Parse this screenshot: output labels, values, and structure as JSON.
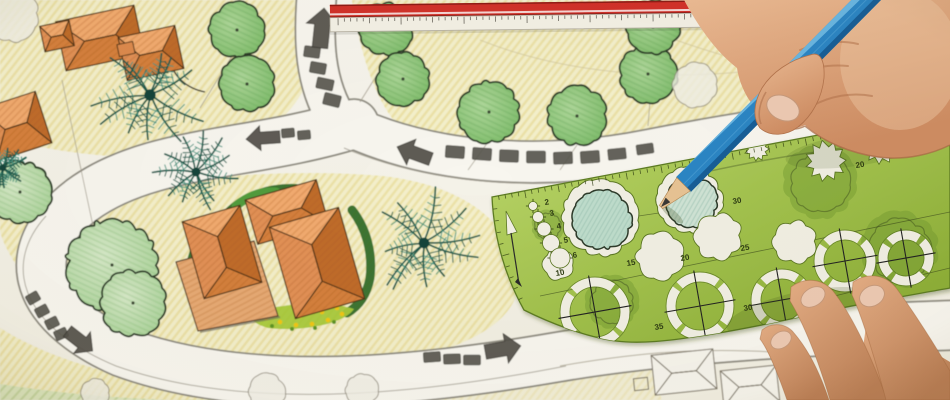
{
  "colors": {
    "paper": "#f6f4ec",
    "paper2": "#f1eee2",
    "lawnFill": "#f3eec6",
    "lawnLine": "#e6da92",
    "lawnGreen": "#dfe8c0",
    "lawnGreenLine": "#c3d59c",
    "roadFill": "#f8f6ef",
    "roadEdge": "#8e8b80",
    "roadThin": "#a09c90",
    "paver": "#5a5850",
    "arrow": "#53514a",
    "ink": "#3a382f",
    "leader": "#a39d8d",
    "arc": "#d2c79c",
    "treeStroke": "#2c3a28",
    "treeMidA": "#aed79a",
    "treeMidB": "#7cbb68",
    "treePaleA": "#d6e9c8",
    "treePaleB": "#a9d398",
    "treeOutline": "#8f897a",
    "palmDark": "#1d5a4c",
    "palmLight": "#459480",
    "roofTop": "#f2ab70",
    "roofBottom": "#d5803d",
    "roofLeft": "#e29157",
    "roofRight": "#c06c2c",
    "roofStroke": "#4a3118",
    "patio": "#e7aa74",
    "hedgeDark": "#2f6a26",
    "hedgeBright": "#54a03e",
    "bedGreen": "#a9c93c",
    "flowerYellow": "#f0c614",
    "flowerGreen": "#5f9427",
    "rulerRed": "#d2322a",
    "rulerRedDark": "#8e1d18",
    "rulerWhite": "#f4f1e6",
    "tick": "#55524a",
    "tplLight": "#bcd76b",
    "tplDark": "#86a830",
    "tplInk": "#2f3d12",
    "tplEdge": "#5d7c24",
    "holePaper": "#f1efe3",
    "holeEdge": "#5b7724",
    "drawnInk": "#2f3b2c",
    "pencilBody": "#2b85c4",
    "pencilLite": "#6db8e4",
    "pencilDark": "#175e97",
    "pencilRidge": "#4da0d4",
    "wood": "#e7c394",
    "woodEdge": "#b5854f",
    "graphite": "#3a3936",
    "skinCrease": "#b3734c",
    "nail": "#edcab3",
    "nailEdge": "#c79a7c",
    "sketch": "#7b7466"
  },
  "plan": {
    "lawns": [
      {
        "d": "M340,0 L950,0 L950,108 C850,124 760,140 655,154 C560,166 468,163 412,138 C382,118 362,66 352,0 Z",
        "o": 1
      },
      {
        "d": "M0,0 L332,0 C324,58 304,108 258,138 C180,168 78,158 0,138 Z",
        "o": 1
      },
      {
        "d": "M0,218 C120,182 262,166 382,176 C472,186 520,230 518,288 C510,338 418,368 298,374 C178,378 80,350 40,300 C14,264 0,240 0,228 Z",
        "o": 1
      },
      {
        "d": "M0,400 L0,328 C60,366 152,388 262,395 C330,399 390,397 436,391 L436,400 Z",
        "o": 1
      },
      {
        "d": "M436,400 L436,391 C520,380 592,370 650,366 L662,400 Z",
        "o": 0.5
      }
    ],
    "lawn_green": "M0,400 L0,384 C80,397 170,402 250,401 L250,400 Z",
    "roads": [
      {
        "d": "M318,-20 C312,40 314,85 340,124",
        "w": 38
      },
      {
        "d": "M330,116 C420,165 540,172 650,150 C760,128 850,118 960,104",
        "w": 40
      },
      {
        "d": "M354,124 C250,156 150,150 82,200 C18,248 28,310 122,352 C252,400 424,380 558,357 C652,341 780,331 960,325",
        "w": 48
      }
    ],
    "road_lines": [
      "M344,148 C440,188 556,192 660,170 C766,148 862,138 950,126",
      "M46,216 C4,262 16,324 116,366 C252,414 432,392 566,366"
    ],
    "arcs": [
      "M480,40 C560,72 660,82 760,70",
      "M640,26 C740,68 850,88 950,80"
    ],
    "leaders": [
      [
        232,
        56,
        200,
        108
      ],
      [
        390,
        54,
        360,
        102
      ],
      [
        488,
        142,
        468,
        170
      ],
      [
        62,
        80,
        96,
        240
      ],
      [
        650,
        101,
        648,
        126
      ],
      [
        118,
        224,
        112,
        262
      ],
      [
        24,
        164,
        20,
        190
      ],
      [
        577,
        145,
        560,
        170
      ]
    ],
    "trees_mid": [
      [
        237,
        30,
        27
      ],
      [
        247,
        84,
        27
      ],
      [
        386,
        29,
        26
      ],
      [
        403,
        79,
        26
      ],
      [
        489,
        112,
        30
      ],
      [
        577,
        116,
        29
      ],
      [
        648,
        74,
        28
      ],
      [
        653,
        27,
        26
      ]
    ],
    "trees_pale": [
      [
        20,
        192,
        30
      ],
      [
        112,
        265,
        44
      ],
      [
        133,
        303,
        32
      ],
      [
        860,
        32,
        26
      ]
    ],
    "trees_outline": [
      [
        12,
        15,
        26
      ],
      [
        695,
        85,
        22
      ],
      [
        267,
        392,
        18
      ],
      [
        362,
        390,
        16
      ],
      [
        95,
        393,
        14
      ]
    ],
    "palms": [
      [
        150,
        95,
        60
      ],
      [
        196,
        172,
        42
      ],
      [
        424,
        243,
        55
      ],
      [
        3,
        168,
        24
      ]
    ],
    "buildings": [
      {
        "x": 287,
        "y": 212,
        "w": 74,
        "h": 46,
        "rot": -16
      },
      {
        "x": 222,
        "y": 252,
        "w": 60,
        "h": 80,
        "rot": -16
      },
      {
        "x": 317,
        "y": 263,
        "w": 72,
        "h": 95,
        "rot": -16
      },
      {
        "x": 100,
        "y": 38,
        "w": 80,
        "h": 50,
        "rot": -12
      },
      {
        "x": 57,
        "y": 36,
        "w": 30,
        "h": 26,
        "rot": -12
      },
      {
        "x": 151,
        "y": 53,
        "w": 58,
        "h": 44,
        "rot": -12
      },
      {
        "x": 16,
        "y": 126,
        "w": 58,
        "h": 54,
        "rot": -18
      }
    ],
    "connector": {
      "x": 126,
      "y": 49,
      "w": 16,
      "h": 12,
      "rot": -12
    },
    "patio": "M176,262 L254,241 L278,316 L198,331 Z",
    "hedges": [
      {
        "d": "M228,212 C244,196 268,187 296,188",
        "w": 8,
        "c": "dark"
      },
      {
        "d": "M196,246 C188,264 186,286 193,304",
        "w": 8,
        "c": "dark"
      },
      {
        "d": "M352,210 C366,228 373,252 370,278 C367,294 359,306 347,313",
        "w": 9,
        "c": "dark"
      },
      {
        "d": "M236,206 C248,196 262,191 276,192",
        "w": 9,
        "c": "bright"
      }
    ],
    "flowerbed": {
      "d": "M252,312 C284,303 330,301 354,309 C344,324 302,332 268,328 C254,324 248,318 252,312 Z",
      "yellow": [
        [
          266,
          318
        ],
        [
          280,
          322
        ],
        [
          296,
          325
        ],
        [
          312,
          324
        ],
        [
          328,
          320
        ],
        [
          342,
          314
        ],
        [
          275,
          313
        ],
        [
          300,
          316
        ],
        [
          322,
          312
        ],
        [
          337,
          308
        ]
      ],
      "green": [
        [
          272,
          326
        ],
        [
          292,
          329
        ],
        [
          315,
          328
        ],
        [
          334,
          322
        ]
      ]
    },
    "pavers": [
      [
        312,
        52,
        16,
        11,
        8
      ],
      [
        318,
        68,
        16,
        11,
        10
      ],
      [
        325,
        84,
        17,
        11,
        12
      ],
      [
        332,
        100,
        17,
        12,
        14
      ],
      [
        288,
        133,
        13,
        9,
        -5
      ],
      [
        304,
        135,
        13,
        9,
        -5
      ],
      [
        455,
        152,
        19,
        12,
        4
      ],
      [
        482,
        154,
        19,
        12,
        4
      ],
      [
        509,
        156,
        19,
        12,
        2
      ],
      [
        536,
        157,
        19,
        12,
        0
      ],
      [
        563,
        158,
        19,
        12,
        -2
      ],
      [
        590,
        157,
        19,
        12,
        -4
      ],
      [
        617,
        154,
        18,
        11,
        -6
      ],
      [
        645,
        149,
        17,
        10,
        -8
      ],
      [
        33,
        298,
        13,
        10,
        -30
      ],
      [
        42,
        311,
        13,
        10,
        -28
      ],
      [
        52,
        323,
        13,
        10,
        -26
      ],
      [
        61,
        334,
        13,
        10,
        -24
      ],
      [
        432,
        357,
        17,
        10,
        -4
      ],
      [
        452,
        359,
        17,
        10,
        -2
      ],
      [
        472,
        360,
        17,
        10,
        0
      ]
    ],
    "arrows": [
      {
        "x": 322,
        "y": 28,
        "len": 40,
        "wid": 26,
        "rot": -84
      },
      {
        "x": 263,
        "y": 138,
        "len": 34,
        "wid": 20,
        "rot": 176
      },
      {
        "x": 414,
        "y": 153,
        "len": 36,
        "wid": 22,
        "rot": 200
      },
      {
        "x": 80,
        "y": 341,
        "len": 32,
        "wid": 22,
        "rot": 38
      },
      {
        "x": 503,
        "y": 349,
        "len": 36,
        "wid": 24,
        "rot": -10
      }
    ],
    "curve_arrow": {
      "d": "M205,92 C185,88 172,75 170,58",
      "head": [
        [
          166,
          60
        ],
        [
          171,
          48
        ],
        [
          176,
          60
        ]
      ]
    },
    "sketch_roofs": [
      {
        "x": 684,
        "y": 372,
        "w": 62,
        "h": 40,
        "rot": -6
      },
      {
        "x": 750,
        "y": 386,
        "w": 56,
        "h": 36,
        "rot": -6
      }
    ],
    "sketch_rect": [
      641,
      384,
      14,
      12,
      -6
    ],
    "sketch_arc": "M560,366 C640,352 700,348 772,352"
  },
  "ruler": {
    "x": 330,
    "y": 1,
    "w": 628,
    "red_h": 13,
    "body_h": 14,
    "rot": -0.7,
    "tick_step": 6.3
  },
  "template": {
    "outline": "M492,197 Q700,158 950,110 L950,288 C900,297 858,304 818,313 C778,322 740,330 700,336 C668,341 640,344 616,341 C585,337 548,322 524,310 Q495,258 492,197 Z",
    "top_edge": {
      "p0": [
        492,
        197
      ],
      "c": [
        700,
        160
      ],
      "p1": [
        950,
        110
      ]
    },
    "left_edge": {
      "p0": [
        492,
        197
      ],
      "c": [
        497,
        258
      ],
      "p1": [
        524,
        310
      ]
    },
    "holes_scallop": [
      {
        "x": 600,
        "y": 218,
        "r": 37,
        "inner": "#bedccb"
      },
      {
        "x": 690,
        "y": 200,
        "r": 32,
        "inner": "#cfe3d4"
      }
    ],
    "holes_spiky": [
      [
        826,
        161,
        20
      ],
      [
        881,
        145,
        19
      ],
      [
        919,
        139,
        12
      ],
      [
        757,
        149,
        12
      ]
    ],
    "holes_cloud": [
      [
        660,
        256,
        22
      ],
      [
        718,
        237,
        22
      ],
      [
        795,
        242,
        20
      ]
    ],
    "holes_flower": [
      [
        558,
        264,
        14
      ]
    ],
    "holes_circle": [
      [
        533,
        206,
        4.5
      ],
      [
        538,
        217,
        5.5
      ],
      [
        544,
        229,
        7
      ],
      [
        551,
        243,
        8.5
      ],
      [
        560,
        258,
        10
      ]
    ],
    "pennant": {
      "tri": [
        [
          506,
          211
        ],
        [
          517,
          232
        ],
        [
          507,
          235
        ]
      ],
      "stem": [
        [
          511,
          233
        ],
        [
          519,
          284
        ]
      ]
    },
    "rings": [
      [
        595,
        312,
        30
      ],
      [
        700,
        306,
        29
      ],
      [
        782,
        300,
        26
      ],
      [
        845,
        261,
        26
      ],
      [
        906,
        258,
        23
      ]
    ],
    "labels": [
      {
        "t": "2",
        "x": 545,
        "y": 205
      },
      {
        "t": "3",
        "x": 550,
        "y": 216
      },
      {
        "t": "4",
        "x": 557,
        "y": 229
      },
      {
        "t": "5",
        "x": 564,
        "y": 243
      },
      {
        "t": "6",
        "x": 573,
        "y": 258
      },
      {
        "t": "10",
        "x": 556,
        "y": 276
      },
      {
        "t": "15",
        "x": 627,
        "y": 266
      },
      {
        "t": "20",
        "x": 681,
        "y": 261
      },
      {
        "t": "25",
        "x": 741,
        "y": 251
      },
      {
        "t": "30",
        "x": 733,
        "y": 204
      },
      {
        "t": "35",
        "x": 655,
        "y": 330
      },
      {
        "t": "30",
        "x": 744,
        "y": 311
      },
      {
        "t": "20",
        "x": 856,
        "y": 168
      }
    ],
    "guides": [
      "M540,296 L950,212",
      "M585,224 L706,206",
      "M818,300 L950,268"
    ],
    "see_lines": [
      "M700,152 C780,136 862,128 950,118",
      "M706,172 C786,154 872,144 950,133"
    ],
    "see_blobs": [
      [
        820,
        182,
        36
      ],
      [
        900,
        250,
        38
      ],
      [
        612,
        302,
        26
      ],
      [
        548,
        226,
        16
      ]
    ]
  },
  "pencil": {
    "body": [
      [
        887.5,
        -6.6
      ],
      [
        691,
        191.7
      ],
      [
        676,
        177.2
      ],
      [
        872.5,
        -21.4
      ]
    ],
    "lite": [
      [
        872.5,
        -21.4
      ],
      [
        676,
        177.2
      ],
      [
        680.7,
        172.6
      ],
      [
        877.2,
        -16.8
      ]
    ],
    "dark": [
      [
        883.6,
        -10.5
      ],
      [
        687.1,
        187.8
      ],
      [
        691,
        191.7
      ],
      [
        887.5,
        -6.6
      ]
    ],
    "ridge": [
      [
        880,
        -14
      ],
      [
        683.5,
        184.3
      ]
    ],
    "wood": [
      [
        690.2,
        191
      ],
      [
        676.8,
        177.6
      ],
      [
        659.4,
        205.5
      ],
      [
        662.6,
        208.6
      ]
    ],
    "graphite": [
      [
        670.3,
        202.2
      ],
      [
        665.7,
        197.6
      ],
      [
        661,
        207
      ]
    ],
    "shadow": {
      "x": 672,
      "y": 214,
      "rx": 14,
      "ry": 4,
      "rot": 40
    }
  },
  "hands": {
    "right_base": "M684,0 C697,24 714,50 737,68 C740,88 751,107 766,118 C780,128 794,131 805,125 C822,141 848,153 877,157 C908,161 933,153 950,145 L950,0 Z",
    "right_creases": [
      "M800,50 C820,42 840,40 858,44",
      "M788,78 C806,68 828,64 848,66",
      "M812,106 C830,96 852,92 872,96"
    ],
    "right_edge": "M766,118 C780,129 794,132 805,126 M805,126 C824,142 850,153 878,157 C908,161 934,153 950,145",
    "thumb": "M810,55 C790,60 772,72 762,88 C754,102 752,118 760,128 C770,137 786,136 798,127 C812,116 822,98 824,78 C825,60 820,51 810,55 Z",
    "thumb_nail": {
      "x": 783,
      "y": 108,
      "rx": 17,
      "ry": 12,
      "rot": 25
    },
    "left_fingers": [
      {
        "d": "M762,330 C772,322 786,323 794,333 C806,347 818,367 829,400 L787,400 C777,371 767,348 760,339 Z",
        "nail": [
          781,
          340,
          11,
          8,
          -32
        ]
      },
      {
        "d": "M791,287 C804,277 822,278 833,291 C849,311 869,349 887,400 L830,400 C818,359 803,322 790,301 Z",
        "nail": [
          813,
          297,
          13,
          9,
          -32
        ]
      },
      {
        "d": "M853,282 C868,272 886,274 897,289 C913,311 935,345 950,371 L950,400 L886,400 C874,355 861,314 852,295 Z",
        "nail": [
          872,
          296,
          13,
          10,
          -28
        ]
      }
    ],
    "left_palm": "M866,326 C898,334 928,348 950,362 L950,400 L856,400 Z",
    "left_shadow": {
      "x": 800,
      "y": 312,
      "rx": 75,
      "ry": 20,
      "rot": -12
    },
    "right_shadow": {
      "x": 855,
      "y": 150,
      "rx": 70,
      "ry": 16,
      "rot": -8
    }
  }
}
